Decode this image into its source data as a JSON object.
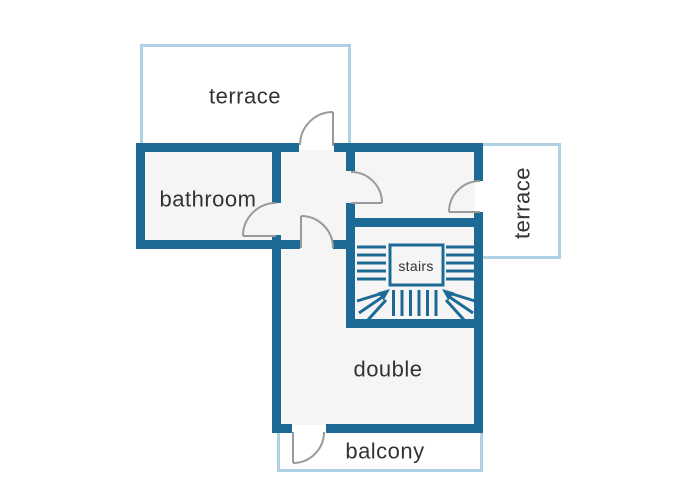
{
  "floorplan": {
    "labels": {
      "terrace_top": "terrace",
      "bathroom": "bathroom",
      "terrace_right": "terrace",
      "stairs": "stairs",
      "double": "double",
      "balcony": "balcony"
    },
    "colors": {
      "wall": "#1e6a96",
      "outdoor_outline": "#aed2e4",
      "interior_floor": "#f5f5f5",
      "door_swing": "#9a9a9a",
      "label_text": "#333333",
      "background": "#ffffff"
    }
  }
}
